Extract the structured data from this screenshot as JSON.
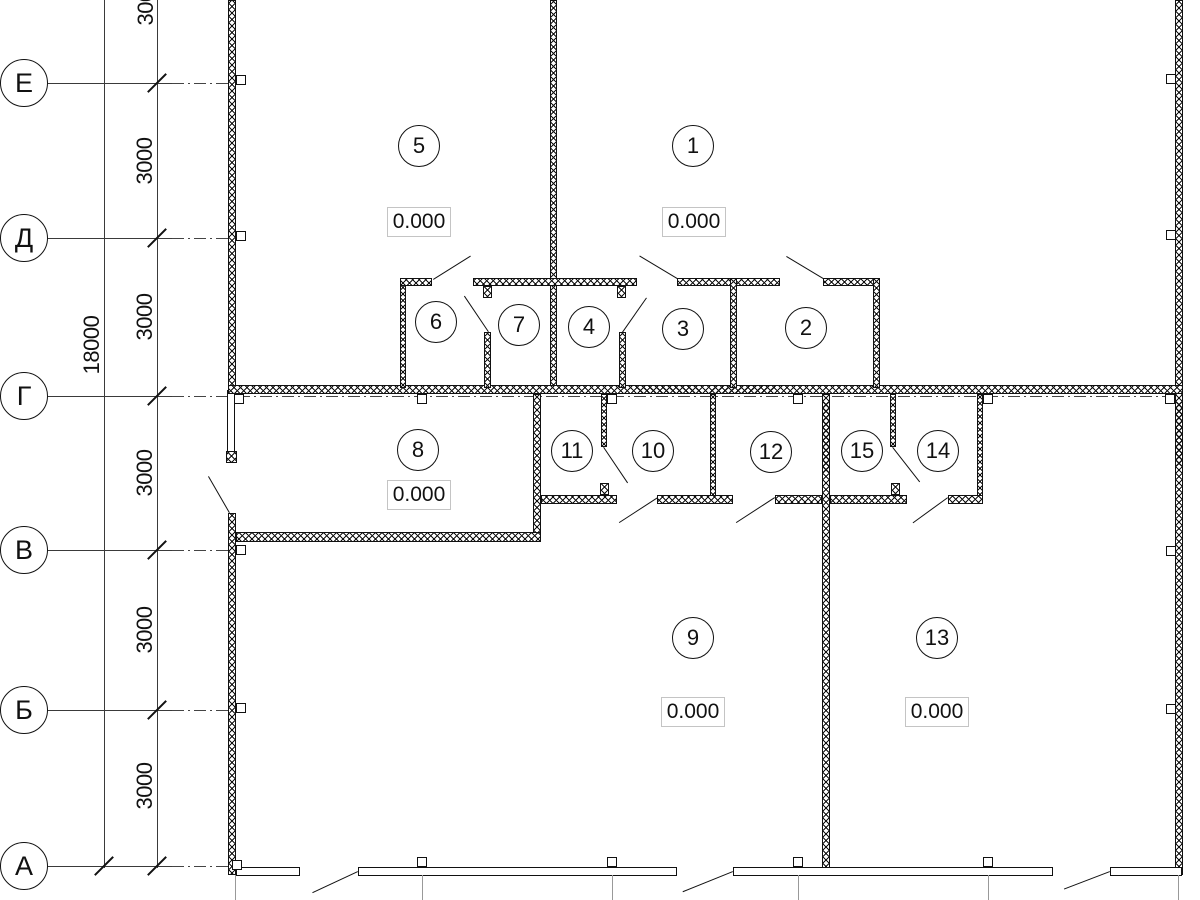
{
  "grid_axes": {
    "row_labels": [
      "Е",
      "Д",
      "Г",
      "В",
      "Б",
      "А"
    ]
  },
  "dimensions": {
    "overall": "18000",
    "segments": [
      "3000",
      "3000",
      "3000",
      "3000",
      "3000",
      "3000"
    ]
  },
  "rooms": [
    {
      "number": "1"
    },
    {
      "number": "2"
    },
    {
      "number": "3"
    },
    {
      "number": "4"
    },
    {
      "number": "5"
    },
    {
      "number": "6"
    },
    {
      "number": "7"
    },
    {
      "number": "8"
    },
    {
      "number": "9"
    },
    {
      "number": "10"
    },
    {
      "number": "11"
    },
    {
      "number": "12"
    },
    {
      "number": "13"
    },
    {
      "number": "14"
    },
    {
      "number": "15"
    }
  ],
  "elevation_marks": [
    "0.000",
    "0.000",
    "0.000",
    "0.000",
    "0.000"
  ]
}
